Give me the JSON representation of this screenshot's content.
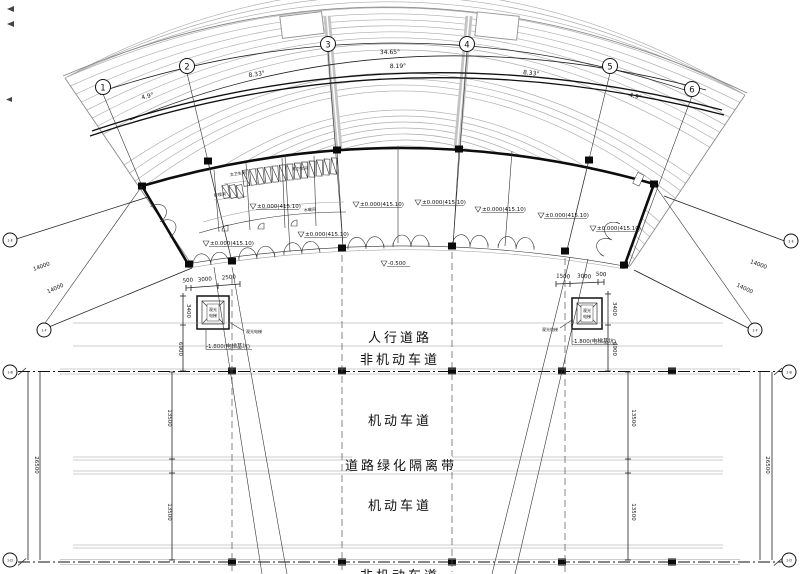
{
  "drawing": {
    "grid_bubbles": {
      "g1": "1",
      "g2": "2",
      "g3": "3",
      "g4": "4",
      "g5": "5",
      "g6": "6"
    },
    "arc_dims": {
      "d12": "4.9°",
      "d23": "8.33°",
      "d34_outer": "34.65°",
      "d34_inner": "8.19°",
      "d45": "8.33°",
      "d56": "4.9°"
    },
    "side_bubbles": {
      "left_diag_top": "1-E",
      "left_diag_mid": "1-F",
      "left_row": "1-B",
      "left_bottom": "1-D",
      "right_diag_top": "1-E",
      "right_diag_mid": "1-F",
      "right_row": "1-B",
      "right_bottom": "1-D"
    },
    "diag_dims": {
      "a": "14000",
      "b": "14000"
    },
    "vertical_dims": {
      "sidewalk": "3400",
      "nonmotor_width": "6900",
      "motor_upper": "13500",
      "motor_lower": "13500",
      "half_width": "26500"
    },
    "entry_dims": {
      "left": [
        "500",
        "3000",
        "2500"
      ],
      "right": [
        "1500",
        "3000",
        "500"
      ]
    },
    "levels": {
      "floor": "±0.000(415.10)",
      "apron": "-0.500",
      "pit": "-1.800(电梯基坑)"
    },
    "elevator": {
      "label_line1": "观光",
      "label_line2": "电梯",
      "callout": "观光电梯"
    },
    "rooms": {
      "r1": "男卫生间",
      "r2": "女卫生间",
      "r3": "管理间",
      "r4": "水暖间"
    },
    "roads": {
      "sidewalk": "人行道路",
      "nonmotor": "非机动车道",
      "motor_upper": "机动车道",
      "green_belt": "道路绿化隔离带",
      "motor_lower": "机动车道",
      "nonmotor_bottom": "非机动车道"
    }
  }
}
